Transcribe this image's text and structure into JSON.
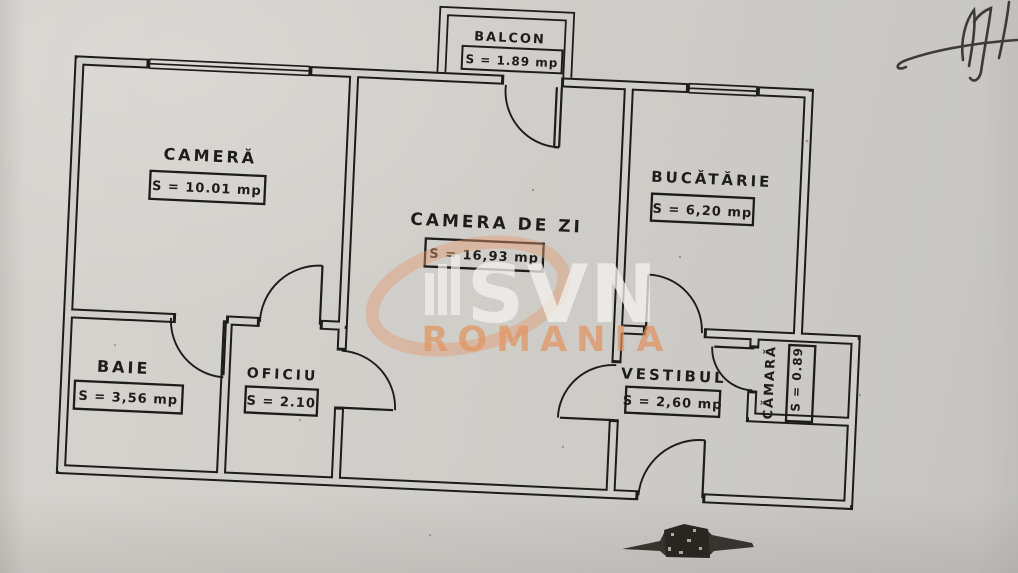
{
  "document": {
    "kind": "apartment floor plan (scanned)",
    "rooms": [
      {
        "id": "balcon",
        "name": "BALCON",
        "area": "S = 1.89 mp"
      },
      {
        "id": "camera",
        "name": "CAMERĂ",
        "area": "S = 10.01 mp"
      },
      {
        "id": "camera_de_zi",
        "name": "CAMERA DE ZI",
        "area": "S = 16,93 mp"
      },
      {
        "id": "bucatarie",
        "name": "BUCĂTĂRIE",
        "area": "S = 6,20 mp"
      },
      {
        "id": "baie",
        "name": "BAIE",
        "area": "S = 3,56 mp"
      },
      {
        "id": "oficiu",
        "name": "OFICIU",
        "area": "S = 2.10"
      },
      {
        "id": "vestibul",
        "name": "VESTIBUL",
        "area": "S = 2,60 mp"
      },
      {
        "id": "camara",
        "name": "CĂMARĂ",
        "area": "S = 0.89"
      }
    ],
    "watermark": {
      "brand": "SVN",
      "country": "ROMANIA",
      "accent_color": "#e2935e",
      "swoosh_color": "#e29b74"
    },
    "colors": {
      "paper": "#cfcec9",
      "ink": "#1c1c1a"
    }
  }
}
